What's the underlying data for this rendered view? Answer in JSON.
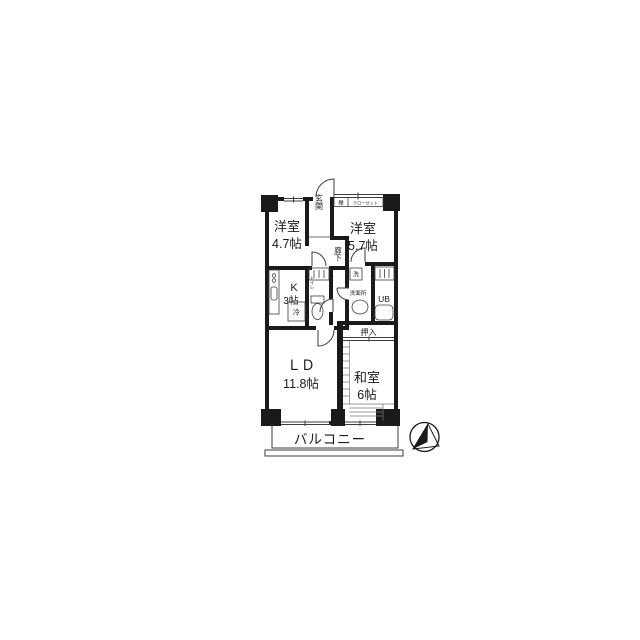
{
  "colors": {
    "bg": "#ffffff",
    "wall": "#1a1a1a",
    "thin": "#3d3d3d",
    "tatami": "#777777",
    "ink": "#1a1a1a"
  },
  "labels": {
    "room1_name": "洋室",
    "room1_size": "4.7帖",
    "room2_name": "洋室",
    "room2_size": "5.7帖",
    "kitchen_name": "K",
    "kitchen_size": "3帖",
    "ld_name": "ＬＤ",
    "ld_size": "11.8帖",
    "washitsu_name": "和室",
    "washitsu_size": "6帖",
    "genkan": "玄関",
    "rouka": "廊下",
    "toilet": "トイレ",
    "senmenjo": "洗面所",
    "ub": "UB",
    "oshiire": "押入",
    "balcony": "バルコニー",
    "shelf": "棚",
    "closet": "クローゼット",
    "fridge": "冷",
    "washer": "洗"
  }
}
